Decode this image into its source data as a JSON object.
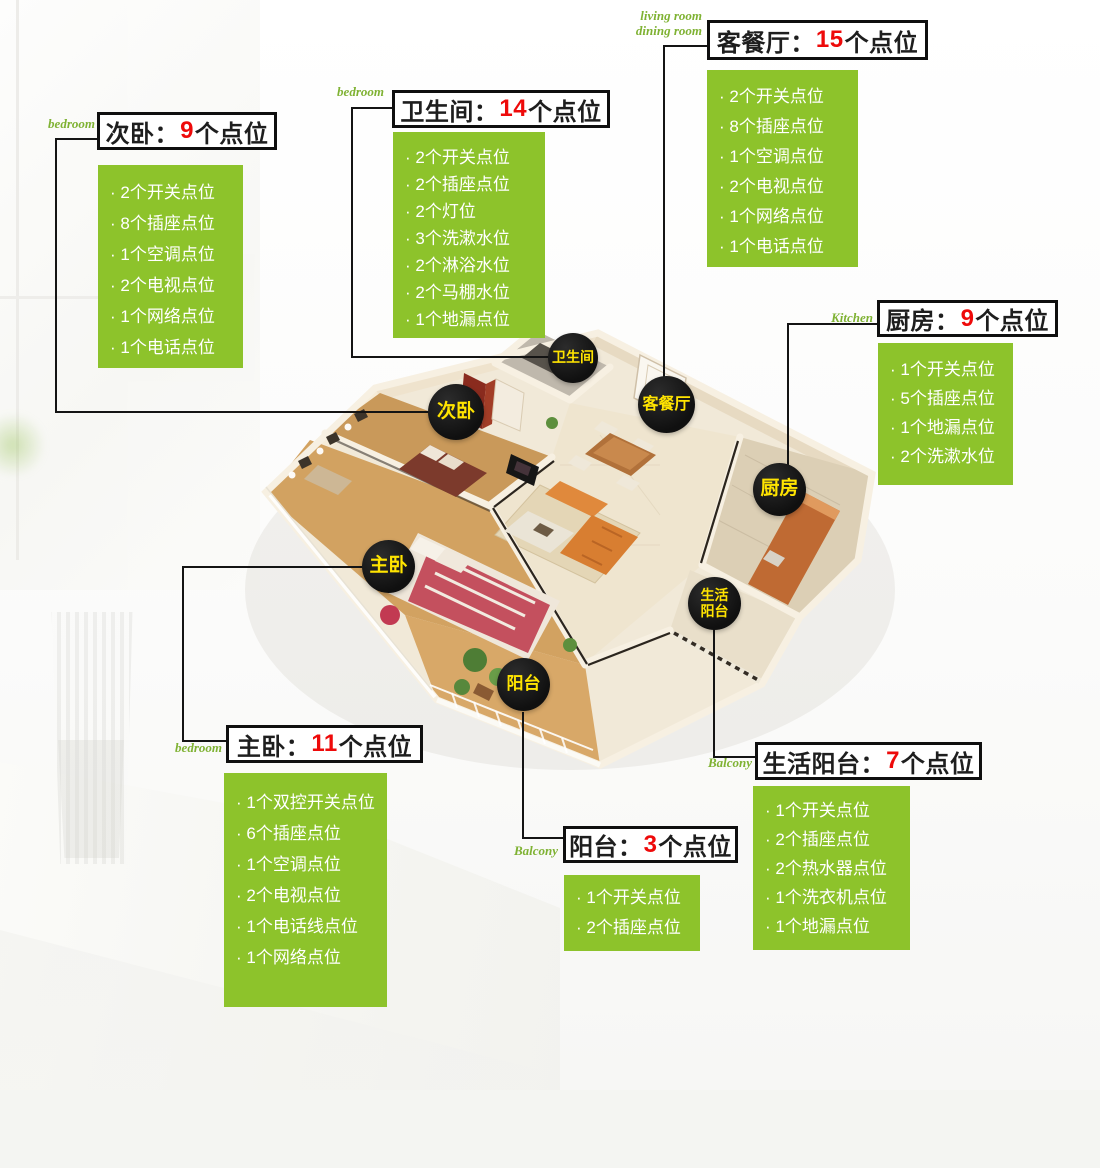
{
  "colors": {
    "accent_green": "#8dc32b",
    "count_red": "#ee0a0a",
    "marker_yellow": "#ffe400",
    "marker_black": "#121212",
    "tag_green": "#7fb233",
    "border_black": "#0f0f0f"
  },
  "sections": [
    {
      "key": "secondary-bedroom",
      "tag": "bedroom",
      "title_prefix": "次卧：",
      "count": "9",
      "title_suffix": "个点位",
      "items": [
        "· 2个开关点位",
        "· 8个插座点位",
        "· 1个空调点位",
        "· 2个电视点位",
        "· 1个网络点位",
        "· 1个电话点位"
      ]
    },
    {
      "key": "bathroom",
      "tag": "bedroom",
      "title_prefix": "卫生间：",
      "count": "14",
      "title_suffix": "个点位",
      "items": [
        "· 2个开关点位",
        "· 2个插座点位",
        "· 2个灯位",
        "· 3个洗漱水位",
        "· 2个淋浴水位",
        "· 2个马棚水位",
        "· 1个地漏点位"
      ]
    },
    {
      "key": "living-dining-room",
      "tag_line1": "living room",
      "tag_line2": "dining room",
      "title_prefix": "客餐厅：",
      "count": "15",
      "title_suffix": "个点位",
      "items": [
        "· 2个开关点位",
        "· 8个插座点位",
        "· 1个空调点位",
        "· 2个电视点位",
        "· 1个网络点位",
        "· 1个电话点位"
      ]
    },
    {
      "key": "kitchen",
      "tag": "Kitchen",
      "title_prefix": "厨房：",
      "count": "9",
      "title_suffix": "个点位",
      "items": [
        "· 1个开关点位",
        "· 5个插座点位",
        "· 1个地漏点位",
        "· 2个洗漱水位"
      ]
    },
    {
      "key": "master-bedroom",
      "tag": "bedroom",
      "title_prefix": "主卧：",
      "count": "11",
      "title_suffix": "个点位",
      "items": [
        "· 1个双控开关点位",
        "· 6个插座点位",
        "· 1个空调点位",
        "· 2个电视点位",
        "· 1个电话线点位",
        "· 1个网络点位"
      ]
    },
    {
      "key": "balcony",
      "tag": "Balcony",
      "title_prefix": "阳台：",
      "count": "3",
      "title_suffix": "个点位",
      "items": [
        "· 1个开关点位",
        "· 2个插座点位"
      ]
    },
    {
      "key": "utility-balcony",
      "tag": "Balcony",
      "title_prefix": "生活阳台：",
      "count": "7",
      "title_suffix": "个点位",
      "items": [
        "· 1个开关点位",
        "· 2个插座点位",
        "· 2个热水器点位",
        "· 1个洗衣机点位",
        "· 1个地漏点位"
      ]
    }
  ],
  "markers": [
    {
      "label": "卫生间"
    },
    {
      "label": "次卧"
    },
    {
      "label": "客餐厅"
    },
    {
      "label": "厨房"
    },
    {
      "label": "主卧"
    },
    {
      "line1": "生活",
      "line2": "阳台"
    },
    {
      "label": "阳台"
    }
  ]
}
